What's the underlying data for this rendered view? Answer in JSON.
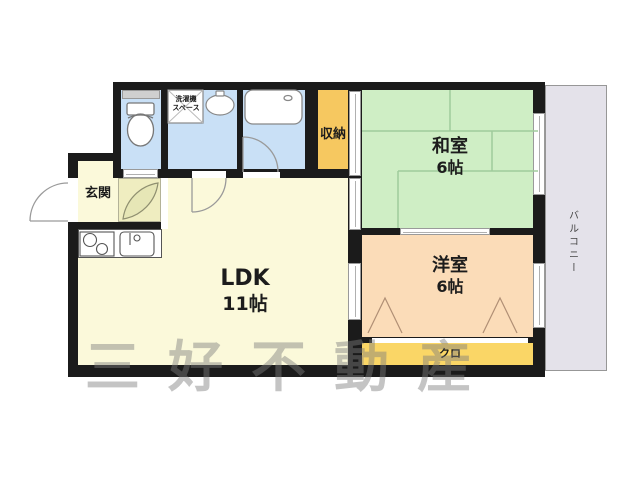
{
  "floorplan": {
    "rooms": {
      "washitsu": {
        "label": "和室",
        "size": "6帖"
      },
      "youshitsu": {
        "label": "洋室",
        "size": "6帖"
      },
      "ldk": {
        "label": "LDK",
        "size": "11帖"
      },
      "genkan": {
        "label": "玄関"
      },
      "storage": {
        "label": "収納"
      },
      "closet": {
        "label": "クロ"
      },
      "balcony": {
        "label": "バルコニー"
      },
      "laundry": {
        "line1": "洗濯機",
        "line2": "スペース"
      }
    },
    "icons": {
      "toilet": "toilet-icon",
      "bathtub": "bathtub-icon",
      "washbasin": "washbasin-icon",
      "stove": "stove-burners-icon",
      "kitchen_sink": "kitchen-sink-icon",
      "laundry_space": "laundry-space-cross-icon",
      "door_swing": "door-swing-arc-icon",
      "closet_fold": "folding-door-triangle-icon"
    },
    "watermark": {
      "text": "三好不動産"
    },
    "colors": {
      "wall": "#1b1b1b",
      "tatami_room": "#cfeec5",
      "tatami_line": "#9fcb9b",
      "western_room": "#fbdcb8",
      "ldk_floor": "#fbf9da",
      "hall_floor": "#efedc0",
      "wet_room": "#c9e0f6",
      "storage": "#f6c860",
      "closet": "#fad666",
      "balcony": "#e4e2ea"
    }
  }
}
